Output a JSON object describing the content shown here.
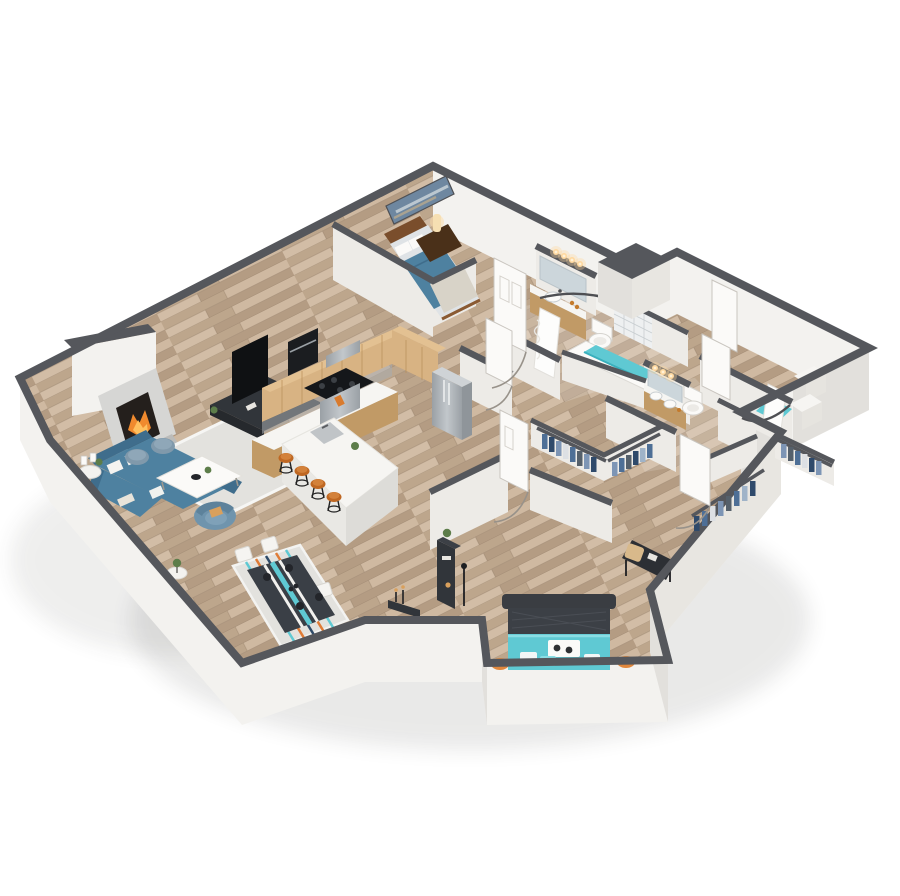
{
  "scene": {
    "label": "3D isometric floor plan of a two-bedroom apartment",
    "style": "isometric-3d-cutaway",
    "rooms": [
      {
        "id": "living-room",
        "label": "Living room with fireplace, sectional sofa, poufs, coffee table, armchair and TV console"
      },
      {
        "id": "kitchen",
        "label": "L-shaped kitchen with wood cabinets, range, refrigerator and white island with four bar stools"
      },
      {
        "id": "dining-area",
        "label": "Dining area with table for four on striped rug"
      },
      {
        "id": "entry",
        "label": "Entry nook with console table and floor lamp"
      },
      {
        "id": "bedroom-2",
        "label": "Second bedroom with blue bed, nightstand, lamp and wall art"
      },
      {
        "id": "bathroom-1",
        "label": "Bathroom with lighted vanity, toilet and soaking tub with tiled shower wall"
      },
      {
        "id": "bathroom-2",
        "label": "Second bathroom with lighted vanity, toilet and curtained shower"
      },
      {
        "id": "walk-in-closet",
        "label": "Walk-in closet with hanging clothes"
      },
      {
        "id": "master-closet",
        "label": "Master walk-in closet with hanging clothes"
      },
      {
        "id": "den",
        "label": "Flex room / den with entry doors"
      },
      {
        "id": "master-bedroom",
        "label": "Master bedroom with teal bed, orange poufs, desk and chair"
      }
    ]
  },
  "palette": {
    "wall_cap": "#55575c",
    "wall_face": "#f3f2ef",
    "wall_shade": "#e2e0dc",
    "wall_inner": "#edebe7",
    "wall_mid": "#e8e6e1",
    "floor": "#c7b098",
    "accent_teal": "#5fc9d3",
    "teal_dark": "#3ab0bd",
    "sofa_blue": "#4e81a0",
    "sofa_blue_dark": "#3f6d8c",
    "chair_blue": "#6f94ad",
    "pouf_gray": "#8099ab",
    "wood_cab": "#d8b383",
    "wood_cab_dark": "#c19a66",
    "wood_warm": "#7a4e2c",
    "counter": "#f6f5f2",
    "steel": "#b3b8bc",
    "dark": "#24262a",
    "console_dark": "#31353a",
    "stool_orange": "#bf6722",
    "fire_orange": "#f08a2e",
    "pouf_orange": "#e0873c",
    "rug_light": "#e3e2de",
    "door": "#fbfaf8",
    "tile": "#eef0f1",
    "mirror": "#ccd6db",
    "light_warm": "#ffd9a0",
    "plant": "#5d7d4a",
    "cl0": "#4e6f96",
    "cl1": "#7d95b5",
    "cl2": "#2f4a6b",
    "cl3": "#9fb3c8",
    "cl4": "#55606b",
    "cl5": "#dde0e4"
  }
}
